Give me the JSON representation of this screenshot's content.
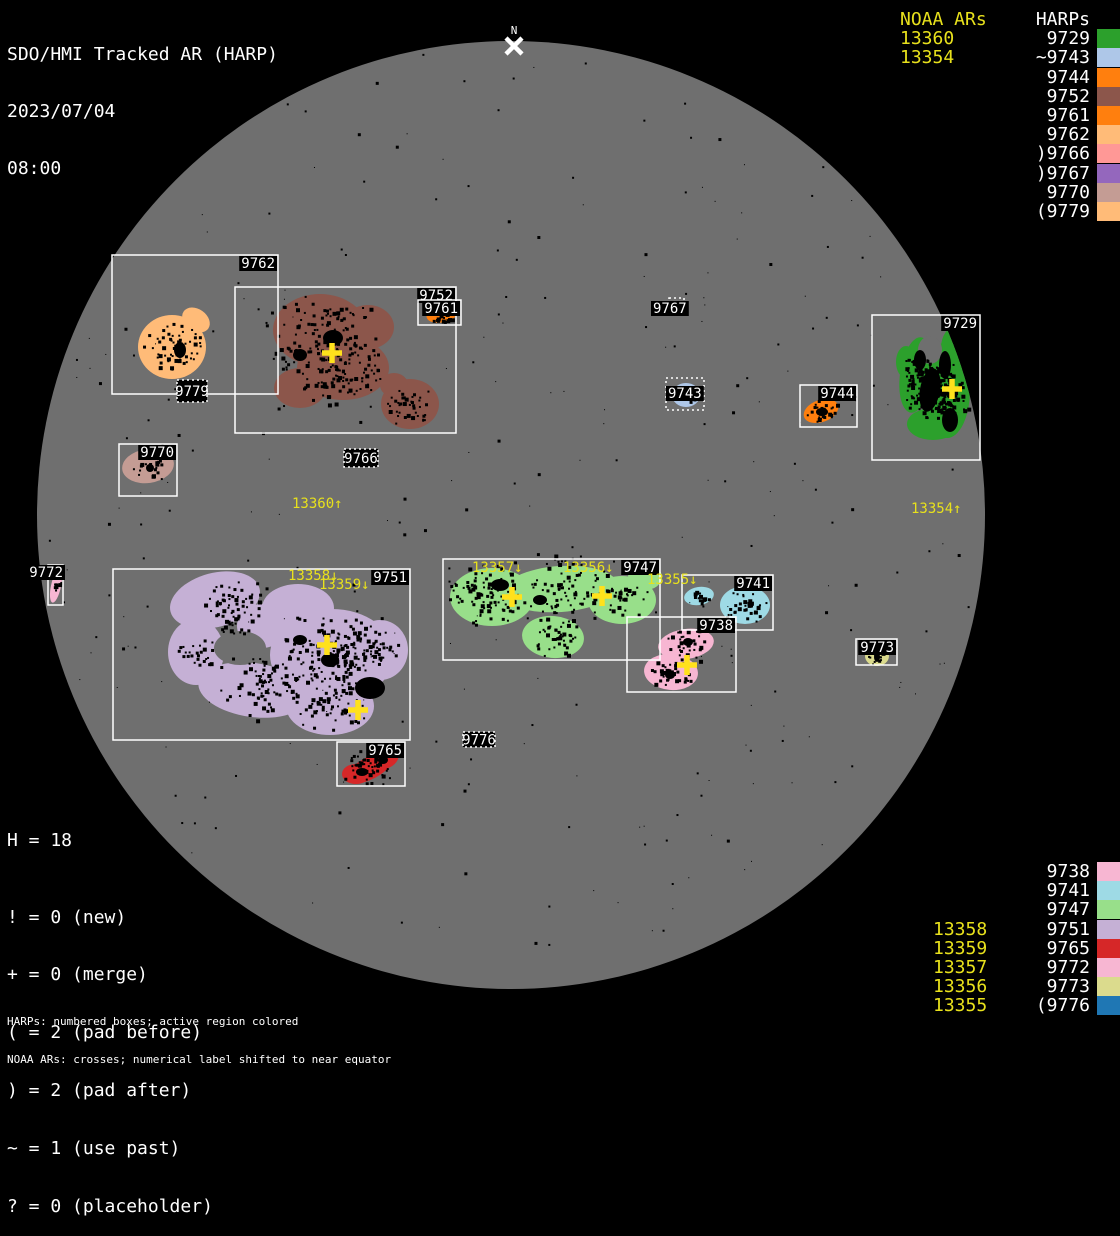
{
  "title": {
    "app": "SDO/HMI Tracked AR (HARP)",
    "date": "2023/07/04",
    "time": "08:00"
  },
  "north_marker": {
    "label": "N"
  },
  "colors": {
    "background": "#000000",
    "disk": "#6f6f6f",
    "box_stroke": "#ffffff",
    "harp_label_text": "#ffffff",
    "label_bg": "#000000",
    "noaa_text": "#e8e11c",
    "cross": "#ffe11c",
    "speckle": "#000000"
  },
  "legend_top_right": {
    "noaa_header": "NOAA ARs",
    "noaa_items": [
      "13360",
      "13354"
    ],
    "harp_header": "HARPs",
    "harp_items": [
      {
        "label": "9729",
        "color": "#2ca02c"
      },
      {
        "label": "~9743",
        "color": "#aec7e8"
      },
      {
        "label": "9744",
        "color": "#ff7f0e"
      },
      {
        "label": "9752",
        "color": "#8c564b"
      },
      {
        "label": "9761",
        "color": "#ff7f0e"
      },
      {
        "label": "9762",
        "color": "#ffbb78"
      },
      {
        "label": ")9766",
        "color": "#ff9896"
      },
      {
        "label": ")9767",
        "color": "#9467bd"
      },
      {
        "label": "9770",
        "color": "#c49c94"
      },
      {
        "label": "(9779",
        "color": "#ffbb78"
      }
    ]
  },
  "legend_bottom_right": {
    "rows": [
      {
        "noaa": "",
        "harp": "9738",
        "color": "#f7b6d2"
      },
      {
        "noaa": "",
        "harp": "9741",
        "color": "#9edae5"
      },
      {
        "noaa": "",
        "harp": "9747",
        "color": "#98df8a"
      },
      {
        "noaa": "13358",
        "harp": "9751",
        "color": "#c5b0d5"
      },
      {
        "noaa": "13359",
        "harp": "9765",
        "color": "#d62728"
      },
      {
        "noaa": "13357",
        "harp": "9772",
        "color": "#f7b6d2"
      },
      {
        "noaa": "13356",
        "harp": "9773",
        "color": "#dbdb8d"
      },
      {
        "noaa": "13355",
        "harp": "(9776",
        "color": "#1f77b4"
      }
    ]
  },
  "stats": {
    "h_line": "H = 18",
    "flags": [
      "! = 0 (new)",
      "+ = 0 (merge)",
      "( = 2 (pad before)",
      ") = 2 (pad after)",
      "~ = 1 (use past)",
      "? = 0 (placeholder)"
    ]
  },
  "footnotes": [
    "HARPs: numbered boxes; active region colored",
    "NOAA ARs: crosses; numerical label shifted to near equator"
  ],
  "chart_data": {
    "type": "scatter",
    "title": "SDO/HMI Tracked AR (HARP)",
    "datetime": "2023/07/04 08:00",
    "legend_position": "right",
    "disk": {
      "cx": 511,
      "cy": 515,
      "r": 474
    },
    "noaa_ars_on_disk": [
      "13360",
      "13354",
      "13358",
      "13359",
      "13357",
      "13356",
      "13355"
    ],
    "noaa_disk_labels": [
      {
        "text": "13360↑",
        "x": 292,
        "y": 508
      },
      {
        "text": "13354↑",
        "x": 911,
        "y": 513
      },
      {
        "text": "13358↓",
        "x": 288,
        "y": 580
      },
      {
        "text": "13359↓",
        "x": 319,
        "y": 589
      },
      {
        "text": "13357↓",
        "x": 472,
        "y": 572
      },
      {
        "text": "13356↓",
        "x": 563,
        "y": 572
      },
      {
        "text": "13355↓",
        "x": 647,
        "y": 584
      }
    ],
    "crosses": [
      [
        332,
        353
      ],
      [
        952,
        389
      ],
      [
        327,
        645
      ],
      [
        358,
        710
      ],
      [
        512,
        597
      ],
      [
        602,
        596
      ],
      [
        687,
        665
      ]
    ],
    "regions": [
      {
        "id": "9762",
        "color": "#ffbb78",
        "box": [
          112,
          255,
          166,
          139
        ],
        "dotted": false,
        "label": {
          "text": "9762",
          "mode": "tr"
        },
        "blobs": [
          [
            172,
            347,
            34,
            32,
            0
          ],
          [
            196,
            320,
            15,
            11,
            35
          ],
          [
            184,
            331,
            11,
            11,
            0
          ]
        ],
        "dark_patches": [
          [
            180,
            350,
            6,
            8,
            0
          ]
        ],
        "clusters": [
          [
            172,
            347,
            24,
            60
          ]
        ]
      },
      {
        "id": "9779",
        "color": "#ffbb78",
        "box": [
          177,
          380,
          30,
          22
        ],
        "dotted": true,
        "box_fill": true,
        "label": {
          "text": "9779",
          "mode": "center"
        },
        "blobs": [],
        "clusters": []
      },
      {
        "id": "9752",
        "color": "#8c564b",
        "box": [
          235,
          287,
          221,
          146
        ],
        "dotted": false,
        "label": {
          "text": "9752",
          "mode": "tr"
        },
        "blobs": [
          [
            320,
            330,
            47,
            36,
            0
          ],
          [
            343,
            368,
            46,
            32,
            0
          ],
          [
            300,
            388,
            26,
            20,
            0
          ],
          [
            368,
            327,
            26,
            22,
            0
          ],
          [
            410,
            404,
            29,
            25,
            0
          ],
          [
            394,
            385,
            14,
            12,
            0
          ]
        ],
        "dark_patches": [
          [
            333,
            338,
            10,
            8,
            0
          ],
          [
            300,
            355,
            7,
            6,
            0
          ]
        ],
        "clusters": [
          [
            320,
            340,
            45,
            140
          ],
          [
            345,
            375,
            35,
            80
          ],
          [
            410,
            404,
            20,
            40
          ]
        ]
      },
      {
        "id": "9761",
        "color": "#ff7f0e",
        "box": [
          418,
          300,
          43,
          25
        ],
        "dotted": false,
        "label": {
          "text": "9761",
          "mode": "tr"
        },
        "blobs": [
          [
            443,
            313,
            17,
            9,
            -15
          ]
        ],
        "clusters": [
          [
            443,
            312,
            11,
            28
          ]
        ]
      },
      {
        "id": "9767",
        "color": "#9467bd",
        "box": [
          669,
          298,
          15,
          13
        ],
        "dotted": true,
        "box_fill": false,
        "label": {
          "text": "9767",
          "mode": "custom",
          "anchor": "start",
          "x": 653,
          "y": 313
        },
        "blobs": [],
        "clusters": []
      },
      {
        "id": "9743",
        "color": "#aec7e8",
        "box": [
          666,
          378,
          38,
          32
        ],
        "dotted": true,
        "box_fill": false,
        "label": {
          "text": "9743",
          "mode": "custom",
          "anchor": "start",
          "x": 668,
          "y": 398
        },
        "blobs": [
          [
            686,
            395,
            14,
            12,
            0
          ]
        ],
        "clusters": [
          [
            687,
            395,
            9,
            14
          ]
        ]
      },
      {
        "id": "9744",
        "color": "#ff7f0e",
        "box": [
          800,
          385,
          57,
          42
        ],
        "dotted": false,
        "label": {
          "text": "9744",
          "mode": "tr"
        },
        "blobs": [
          [
            821,
            411,
            18,
            11,
            -20
          ]
        ],
        "dark_patches": [
          [
            822,
            412,
            6,
            4,
            0
          ]
        ],
        "clusters": [
          [
            821,
            411,
            12,
            30
          ]
        ]
      },
      {
        "id": "9729",
        "color": "#2ca02c",
        "box": [
          872,
          315,
          108,
          145
        ],
        "dotted": false,
        "label": {
          "text": "9729",
          "mode": "tr"
        },
        "blobs": [
          [
            916,
            375,
            16,
            38,
            8
          ],
          [
            947,
            390,
            23,
            48,
            0
          ],
          [
            933,
            424,
            26,
            16,
            0
          ],
          [
            956,
            348,
            15,
            22,
            0
          ],
          [
            906,
            362,
            10,
            16,
            0
          ]
        ],
        "holes": [
          [
            930,
            350,
            12,
            14,
            0
          ]
        ],
        "dark_patches": [
          [
            930,
            390,
            10,
            22,
            10
          ],
          [
            950,
            420,
            8,
            12,
            0
          ],
          [
            920,
            360,
            6,
            10,
            0
          ],
          [
            945,
            365,
            6,
            14,
            0
          ]
        ],
        "clusters": [
          [
            940,
            390,
            28,
            200
          ],
          [
            920,
            370,
            15,
            60
          ]
        ]
      },
      {
        "id": "9770",
        "color": "#c49c94",
        "box": [
          119,
          444,
          58,
          52
        ],
        "dotted": false,
        "label": {
          "text": "9770",
          "mode": "tr"
        },
        "blobs": [
          [
            148,
            466,
            26,
            17,
            -8
          ]
        ],
        "dark_patches": [
          [
            150,
            468,
            4,
            4,
            0
          ]
        ],
        "clusters": [
          [
            148,
            466,
            13,
            22
          ]
        ]
      },
      {
        "id": "9766",
        "color": "#ff9896",
        "box": [
          344,
          449,
          34,
          18
        ],
        "dotted": true,
        "box_fill": true,
        "label": {
          "text": "9766",
          "mode": "center"
        },
        "blobs": [],
        "clusters": []
      },
      {
        "id": "9772",
        "color": "#f7b6d2",
        "box": [
          48,
          565,
          15,
          40
        ],
        "dotted": false,
        "label": {
          "text": "9772",
          "mode": "custom",
          "anchor": "end",
          "x": 63,
          "y": 577
        },
        "blobs": [
          [
            56,
            586,
            5,
            17,
            12
          ]
        ],
        "clusters": [
          [
            56,
            585,
            5,
            10
          ]
        ]
      },
      {
        "id": "9751",
        "color": "#c5b0d5",
        "box": [
          113,
          569,
          297,
          171
        ],
        "dotted": false,
        "label": {
          "text": "9751",
          "mode": "tr"
        },
        "blobs": [
          [
            215,
            600,
            46,
            27,
            -15
          ],
          [
            298,
            608,
            36,
            24,
            0
          ],
          [
            332,
            655,
            62,
            46,
            0
          ],
          [
            196,
            652,
            28,
            33,
            0
          ],
          [
            253,
            690,
            55,
            27,
            8
          ],
          [
            330,
            706,
            44,
            29,
            0
          ],
          [
            262,
            626,
            25,
            22,
            0
          ],
          [
            380,
            650,
            28,
            30,
            0
          ]
        ],
        "holes": [
          [
            240,
            648,
            26,
            17,
            0
          ]
        ],
        "dark_patches": [
          [
            370,
            688,
            15,
            11,
            0
          ],
          [
            330,
            660,
            9,
            7,
            0
          ],
          [
            300,
            640,
            7,
            5,
            0
          ]
        ],
        "clusters": [
          [
            232,
            607,
            28,
            70
          ],
          [
            330,
            650,
            42,
            150
          ],
          [
            262,
            686,
            32,
            80
          ],
          [
            330,
            703,
            28,
            60
          ],
          [
            198,
            652,
            16,
            25
          ],
          [
            375,
            645,
            20,
            35
          ]
        ]
      },
      {
        "id": "9765",
        "color": "#d62728",
        "box": [
          337,
          742,
          68,
          44
        ],
        "dotted": false,
        "label": {
          "text": "9765",
          "mode": "tr"
        },
        "blobs": [
          [
            370,
            768,
            26,
            11,
            -28
          ],
          [
            356,
            774,
            14,
            10,
            0
          ],
          [
            384,
            759,
            15,
            10,
            -20
          ]
        ],
        "dark_patches": [
          [
            362,
            772,
            6,
            4,
            0
          ],
          [
            383,
            760,
            5,
            4,
            0
          ]
        ],
        "clusters": [
          [
            370,
            767,
            18,
            45
          ]
        ]
      },
      {
        "id": "9776",
        "color": "#1f77b4",
        "box": [
          463,
          732,
          32,
          15
        ],
        "dotted": true,
        "box_fill": true,
        "label": {
          "text": "9776",
          "mode": "center"
        },
        "blobs": [],
        "clusters": []
      },
      {
        "id": "9747",
        "color": "#98df8a",
        "box": [
          443,
          559,
          217,
          101
        ],
        "dotted": false,
        "label": {
          "text": "9747",
          "mode": "tr"
        },
        "blobs": [
          [
            492,
            597,
            42,
            29,
            0
          ],
          [
            560,
            589,
            58,
            23,
            -4
          ],
          [
            622,
            600,
            34,
            24,
            0
          ],
          [
            645,
            577,
            17,
            13,
            0
          ],
          [
            553,
            637,
            31,
            21,
            5
          ]
        ],
        "dark_patches": [
          [
            500,
            585,
            9,
            6,
            0
          ],
          [
            540,
            600,
            7,
            5,
            0
          ],
          [
            248,
            0,
            0,
            0,
            0
          ]
        ],
        "clusters": [
          [
            490,
            596,
            32,
            100
          ],
          [
            565,
            590,
            38,
            80
          ],
          [
            553,
            637,
            20,
            45
          ],
          [
            620,
            600,
            20,
            30
          ]
        ]
      },
      {
        "id": "9741",
        "color": "#9edae5",
        "box": [
          682,
          575,
          91,
          55
        ],
        "dotted": false,
        "label": {
          "text": "9741",
          "mode": "tr"
        },
        "blobs": [
          [
            699,
            596,
            15,
            9,
            -10
          ],
          [
            745,
            605,
            25,
            19,
            0
          ]
        ],
        "clusters": [
          [
            699,
            596,
            9,
            14
          ],
          [
            745,
            605,
            17,
            40
          ]
        ]
      },
      {
        "id": "9738",
        "color": "#f7b6d2",
        "box": [
          627,
          617,
          109,
          75
        ],
        "dotted": false,
        "label": {
          "text": "9738",
          "mode": "tr"
        },
        "blobs": [
          [
            686,
            644,
            28,
            15,
            -8
          ],
          [
            671,
            672,
            27,
            18,
            5
          ]
        ],
        "dark_patches": [
          [
            688,
            642,
            5,
            4,
            0
          ],
          [
            670,
            675,
            5,
            4,
            0
          ]
        ],
        "clusters": [
          [
            686,
            645,
            18,
            35
          ],
          [
            671,
            672,
            18,
            40
          ]
        ]
      },
      {
        "id": "9773",
        "color": "#dbdb8d",
        "box": [
          856,
          639,
          41,
          26
        ],
        "dotted": false,
        "label": {
          "text": "9773",
          "mode": "tr"
        },
        "blobs": [
          [
            877,
            656,
            12,
            10,
            0
          ]
        ],
        "dark_patches": [
          [
            877,
            657,
            3,
            5,
            0
          ]
        ],
        "clusters": [
          [
            877,
            655,
            8,
            16
          ]
        ]
      }
    ]
  }
}
